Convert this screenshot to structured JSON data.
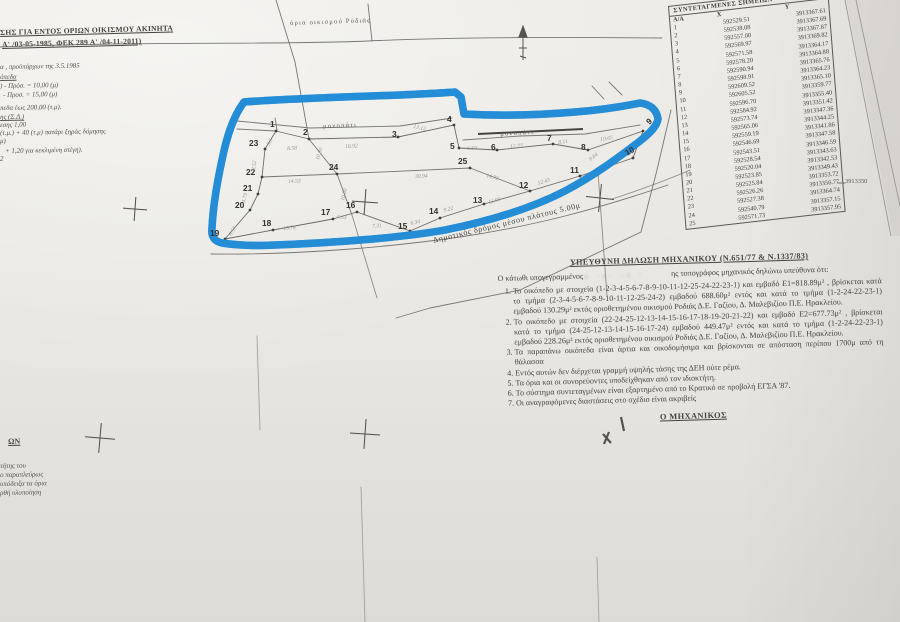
{
  "document": {
    "type_note": "scanned topographic survey plan photo",
    "header_lines": [
      "ΣΗΣ ΓΙΑ ΕΝΤΟΣ ΟΡΙΩΝ ΟΙΚΙΣΜΟΥ ΑΚΙΝΗΤΑ",
      "Α' /03-05-1985, ΦΕΚ 289 Α' /04-11-2011)"
    ],
    "highlight_color": "#1d8ad6"
  },
  "coordinates_table": {
    "title": "ΣΥΝΤΕΤΑΓΜΕΝΕΣ ΣΗΜΕΙΩΝ",
    "columns": [
      "Α/Α",
      "X",
      "Y"
    ],
    "rows": [
      [
        "1",
        "592529.51",
        "3913367.61"
      ],
      [
        "2",
        "592538.08",
        "3913367.69"
      ],
      [
        "3",
        "592557.00",
        "3913367.87"
      ],
      [
        "4",
        "592569.97",
        "3913369.82"
      ],
      [
        "5",
        "592571.58",
        "3913364.17"
      ],
      [
        "6",
        "592578.20",
        "3913364.88"
      ],
      [
        "7",
        "592590.94",
        "3913365.76"
      ],
      [
        "8",
        "592598.91",
        "3913364.23"
      ],
      [
        "9",
        "592609.52",
        "3913365.10"
      ],
      [
        "10",
        "592605.52",
        "3913359.77"
      ],
      [
        "11",
        "592596.70",
        "3913355.40"
      ],
      [
        "12",
        "592584.92",
        "3913351.42"
      ],
      [
        "13",
        "592573.74",
        "3913347.36"
      ],
      [
        "14",
        "592565.06",
        "3913344.25"
      ],
      [
        "15",
        "592559.19",
        "3913341.86"
      ],
      [
        "16",
        "592546.69",
        "3913347.58"
      ],
      [
        "17",
        "592543.51",
        "3913346.59"
      ],
      [
        "18",
        "592528.54",
        "3913343.63"
      ],
      [
        "19",
        "592520.04",
        "3913342.53"
      ],
      [
        "20",
        "592523.85",
        "3913349.43"
      ],
      [
        "21",
        "592525.84",
        "3913353.72"
      ],
      [
        "22",
        "592526.26",
        "3913356.77"
      ],
      [
        "23",
        "592527.38",
        "3913364.74"
      ],
      [
        "24",
        "592540.79",
        "3913357.15"
      ],
      [
        "25",
        "592571.73",
        "3913357.95"
      ]
    ],
    "grid_label": "3913350"
  },
  "declaration": {
    "title": "ΥΠΕΥΘΥΝΗ ΔΗΛΩΣΗ ΜΗΧΑΝΙΚΟΥ (Ν.651/77 & Ν.1337/83)",
    "intro_before": "Ο κάτωθι υπογεγραμμένος",
    "name_smudge": "ι ·ι· -ι ·",
    "intro_after": "ης τοπογράφος μηχανικός δηλώνω υπεύθυνα ότι:",
    "items": [
      "Το οικόπεδο με στοιχεία (1-2-3-4-5-6-7-8-9-10-11-12-25-24-22-23-1) και εμβαδό Ε1=818.89μ² , βρίσκεται κατά το τμήμα (2-3-4-5-6-7-8-9-10-11-12-25-24-2) εμβαδού 688.60μ² εντός και κατά το τμήμα (1-2-24-22-23-1) εμβαδού 130.29μ² εκτός οριοθετημένου οικισμού Ροδιάς Δ.Ε. Γαζίου, Δ. Μαλεβιζίου Π.Ε. Ηρακλείου.",
      "Το οικόπεδο με στοιχεία (22-24-25-12-13-14-15-16-17-18-19-20-21-22) και εμβαδό Ε2=677.73μ² , βρίσκεται κατά το τμήμα (24-25-12-13-14-15-16-17-24) εμβαδού 449.47μ² εντός και κατά το τμήμα (1-2-24-22-23-1) εμβαδού 228.26μ² εκτός οριοθετημένου οικισμού Ροδιάς Δ.Ε. Γαζίου, Δ. Μαλεβιζίου Π.Ε. Ηρακλείου.",
      "Τα παραπάνω οικόπεδα είναι άρτια και οικοδομήσιμα και βρίσκονται σε απόσταση περίπου 1700μ από τη θάλασσα",
      "Εντός αυτών δεν διέρχεται γραμμή υψηλής τάσης της ΔΕΗ ούτε ρέμα.",
      "Τα όρια και οι συνορεύοντες υποδείχθηκαν από τον ιδιοκτήτη.",
      "Το σύστημα συντεταγμένων είναι εξαρτημένο από το Κρατικό σε προβολή ΕΓΣΑ '87.",
      "Οι αναγραφόμενες διαστάσεις στο σχέδιο είναι ακριβείς"
    ],
    "signature": "Ο ΜΗΧΑΝΙΚΟΣ"
  },
  "labels": [
    {
      "t": "ΣΗΣ ΓΙΑ ΕΝΤΟΣ ΟΡΙΩΝ ΟΙΚΙΣΜΟΥ ΑΚΙΝΗΤΑ",
      "x": 0,
      "y": 28,
      "r": -1.5,
      "c": "heading",
      "n": "header-line-1"
    },
    {
      "t": "Α' /03-05-1985, ΦΕΚ 289 Α' /04-11-2011)",
      "x": 2,
      "y": 40,
      "r": -1.5,
      "c": "heading",
      "n": "header-line-2"
    },
    {
      "t": "α , προϋπάρχων της 3.5.1985",
      "x": 0,
      "y": 64,
      "r": -1,
      "c": "note",
      "n": "note-line"
    },
    {
      "t": "όπεδα",
      "x": 0,
      "y": 74,
      "r": -1,
      "c": "note u",
      "n": "note-line"
    },
    {
      "t": ") - Πρόσ. = 10,00 (μ)",
      "x": 0,
      "y": 83,
      "r": -1,
      "c": "note",
      "n": "note-line"
    },
    {
      "t": "- Προσ. = 15,00 (μ)",
      "x": 3,
      "y": 92,
      "r": -1,
      "c": "note",
      "n": "note-line"
    },
    {
      "t": "πεδα έως 200,00 (τ.μ).",
      "x": 0,
      "y": 105,
      "r": -1,
      "c": "note",
      "n": "note-line"
    },
    {
      "t": "ης (Σ.Δ.)",
      "x": 0,
      "y": 114,
      "r": -1,
      "c": "note u",
      "n": "note-line"
    },
    {
      "t": "εσης 1,00",
      "x": 0,
      "y": 122,
      "r": -1,
      "c": "note",
      "n": "note-line"
    },
    {
      "t": "(τ.μ.) + 40 (τ.μ) πατάρι ξηράς δόμησης",
      "x": 0,
      "y": 130,
      "r": -1,
      "c": "note",
      "n": "note-line"
    },
    {
      "t": "μ)",
      "x": 0,
      "y": 138,
      "r": -1,
      "c": "note",
      "n": "note-line"
    },
    {
      "t": "+ 1,20 για κεκλιμένη στέγη).",
      "x": 5,
      "y": 148,
      "r": -1,
      "c": "note",
      "n": "note-line"
    },
    {
      "t": "2",
      "x": 0,
      "y": 156,
      "r": 0,
      "c": "note",
      "n": "note-line"
    },
    {
      "t": "όρια οικισμού Ροδιάς",
      "x": 290,
      "y": 20,
      "r": -2,
      "c": "maplabel",
      "n": "settlement-boundary-label"
    },
    {
      "t": "μονοπάτι",
      "x": 323,
      "y": 123,
      "r": -2,
      "c": "maplabel",
      "n": "footpath-label"
    },
    {
      "t": "μονοπάτι",
      "x": 500,
      "y": 131,
      "r": -4,
      "c": "maplabel",
      "n": "footpath-label"
    },
    {
      "t": "Δημοτικός δρόμος μέσου πλάτους 5.00μ",
      "x": 432,
      "y": 236,
      "r": -13.5,
      "c": "roadlabel",
      "n": "road-label"
    },
    {
      "t": "3913350",
      "x": 845,
      "y": 178,
      "r": 0,
      "c": "grid",
      "n": "grid-northing-label"
    },
    {
      "t": "ΩΝ",
      "x": 8,
      "y": 437,
      "r": -1,
      "c": "fragheading",
      "n": "bottom-left-heading"
    },
    {
      "t": "τήτης του",
      "x": 0,
      "y": 462,
      "r": -1,
      "c": "frag",
      "n": "bottom-left-line"
    },
    {
      "t": "ο παραπλεύρως",
      "x": 0,
      "y": 471,
      "r": -1,
      "c": "frag",
      "n": "bottom-left-line"
    },
    {
      "t": "υπόδειξα τα όρια",
      "x": 0,
      "y": 480,
      "r": -1,
      "c": "frag",
      "n": "bottom-left-line"
    },
    {
      "t": "ρθή υλοποίηση",
      "x": 0,
      "y": 489,
      "r": -1,
      "c": "frag",
      "n": "bottom-left-line"
    },
    {
      "t": "1",
      "x": 270,
      "y": 119,
      "r": 0,
      "c": "ptlabel",
      "n": "point-label-1"
    },
    {
      "t": "2",
      "x": 303,
      "y": 127,
      "r": 0,
      "c": "ptlabel",
      "n": "point-label-2"
    },
    {
      "t": "3",
      "x": 392,
      "y": 129,
      "r": 0,
      "c": "ptlabel",
      "n": "point-label-3"
    },
    {
      "t": "4",
      "x": 447,
      "y": 114,
      "r": 0,
      "c": "ptlabel",
      "n": "point-label-4"
    },
    {
      "t": "5",
      "x": 450,
      "y": 141,
      "r": 0,
      "c": "ptlabel",
      "n": "point-label-5"
    },
    {
      "t": "6",
      "x": 491,
      "y": 142,
      "r": 0,
      "c": "ptlabel",
      "n": "point-label-6"
    },
    {
      "t": "7",
      "x": 547,
      "y": 133,
      "r": 0,
      "c": "ptlabel",
      "n": "point-label-7"
    },
    {
      "t": "8",
      "x": 581,
      "y": 142,
      "r": 0,
      "c": "ptlabel",
      "n": "point-label-8"
    },
    {
      "t": "9",
      "x": 644,
      "y": 119,
      "r": -40,
      "c": "ptlabel",
      "n": "point-label-9"
    },
    {
      "t": "10",
      "x": 623,
      "y": 149,
      "r": -30,
      "c": "ptlabel",
      "n": "point-label-10"
    },
    {
      "t": "11",
      "x": 570,
      "y": 165,
      "r": 0,
      "c": "ptlabel",
      "n": "point-label-11"
    },
    {
      "t": "12",
      "x": 519,
      "y": 180,
      "r": 0,
      "c": "ptlabel",
      "n": "point-label-12"
    },
    {
      "t": "13",
      "x": 473,
      "y": 195,
      "r": 0,
      "c": "ptlabel",
      "n": "point-label-13"
    },
    {
      "t": "14",
      "x": 429,
      "y": 206,
      "r": 0,
      "c": "ptlabel",
      "n": "point-label-14"
    },
    {
      "t": "15",
      "x": 398,
      "y": 221,
      "r": 0,
      "c": "ptlabel",
      "n": "point-label-15"
    },
    {
      "t": "16",
      "x": 346,
      "y": 200,
      "r": 0,
      "c": "ptlabel",
      "n": "point-label-16"
    },
    {
      "t": "17",
      "x": 321,
      "y": 207,
      "r": 0,
      "c": "ptlabel",
      "n": "point-label-17"
    },
    {
      "t": "18",
      "x": 262,
      "y": 218,
      "r": 0,
      "c": "ptlabel",
      "n": "point-label-18"
    },
    {
      "t": "19",
      "x": 210,
      "y": 228,
      "r": 0,
      "c": "ptlabel",
      "n": "point-label-19"
    },
    {
      "t": "20",
      "x": 235,
      "y": 200,
      "r": 0,
      "c": "ptlabel",
      "n": "point-label-20"
    },
    {
      "t": "21",
      "x": 243,
      "y": 183,
      "r": 0,
      "c": "ptlabel",
      "n": "point-label-21"
    },
    {
      "t": "22",
      "x": 246,
      "y": 167,
      "r": 0,
      "c": "ptlabel",
      "n": "point-label-22"
    },
    {
      "t": "23",
      "x": 249,
      "y": 138,
      "r": 0,
      "c": "ptlabel",
      "n": "point-label-23"
    },
    {
      "t": "24",
      "x": 329,
      "y": 162,
      "r": 0,
      "c": "ptlabel",
      "n": "point-label-24"
    },
    {
      "t": "25",
      "x": 458,
      "y": 156,
      "r": 0,
      "c": "ptlabel",
      "n": "point-label-25"
    },
    {
      "t": "8.58",
      "x": 287,
      "y": 146,
      "r": -3,
      "c": "dim",
      "n": "dimension-label"
    },
    {
      "t": "18.92",
      "x": 345,
      "y": 144,
      "r": -3,
      "c": "dim",
      "n": "dimension-label"
    },
    {
      "t": "13.12",
      "x": 414,
      "y": 124,
      "r": 12,
      "c": "dim",
      "n": "dimension-label"
    },
    {
      "t": "6.60",
      "x": 467,
      "y": 146,
      "r": -2,
      "c": "dim",
      "n": "dimension-label"
    },
    {
      "t": "12.77",
      "x": 510,
      "y": 144,
      "r": -3,
      "c": "dim",
      "n": "dimension-label"
    },
    {
      "t": "8.11",
      "x": 558,
      "y": 140,
      "r": -8,
      "c": "dim",
      "n": "dimension-label"
    },
    {
      "t": "10.65",
      "x": 600,
      "y": 137,
      "r": -8,
      "c": "dim",
      "n": "dimension-label"
    },
    {
      "t": "9.84",
      "x": 588,
      "y": 158,
      "r": -38,
      "c": "dim",
      "n": "dimension-label"
    },
    {
      "t": "12.43",
      "x": 537,
      "y": 181,
      "r": -17,
      "c": "dim",
      "n": "dimension-label"
    },
    {
      "t": "11.90",
      "x": 488,
      "y": 200,
      "r": -15,
      "c": "dim",
      "n": "dimension-label"
    },
    {
      "t": "9.22",
      "x": 443,
      "y": 208,
      "r": -14,
      "c": "dim",
      "n": "dimension-label"
    },
    {
      "t": "6.34",
      "x": 410,
      "y": 221,
      "r": -12,
      "c": "dim",
      "n": "dimension-label"
    },
    {
      "t": "7.31",
      "x": 372,
      "y": 224,
      "r": -6,
      "c": "dim",
      "n": "dimension-label"
    },
    {
      "t": "4.33",
      "x": 337,
      "y": 214,
      "r": 8,
      "c": "dim",
      "n": "dimension-label"
    },
    {
      "t": "15.76",
      "x": 283,
      "y": 226,
      "r": -4,
      "c": "dim",
      "n": "dimension-label"
    },
    {
      "t": "8.57",
      "x": 228,
      "y": 234,
      "r": -58,
      "c": "dim",
      "n": "dimension-label"
    },
    {
      "t": "4.73",
      "x": 241,
      "y": 202,
      "r": -75,
      "c": "dim",
      "n": "dimension-label"
    },
    {
      "t": "8.52",
      "x": 251,
      "y": 170,
      "r": -82,
      "c": "dim",
      "n": "dimension-label"
    },
    {
      "t": "3.5",
      "x": 266,
      "y": 144,
      "r": -62,
      "c": "dim",
      "n": "dimension-label"
    },
    {
      "t": "14.53",
      "x": 288,
      "y": 179,
      "r": -2,
      "c": "dim",
      "n": "dimension-label"
    },
    {
      "t": "30.94",
      "x": 415,
      "y": 174,
      "r": -2,
      "c": "dim",
      "n": "dimension-label"
    },
    {
      "t": "14.72",
      "x": 487,
      "y": 173,
      "r": 16,
      "c": "dim",
      "n": "dimension-label"
    },
    {
      "t": "10.80",
      "x": 315,
      "y": 159,
      "r": -72,
      "c": "dim",
      "n": "dimension-label"
    },
    {
      "t": "10.80",
      "x": 340,
      "y": 200,
      "r": -75,
      "c": "dim",
      "n": "dimension-label"
    }
  ]
}
